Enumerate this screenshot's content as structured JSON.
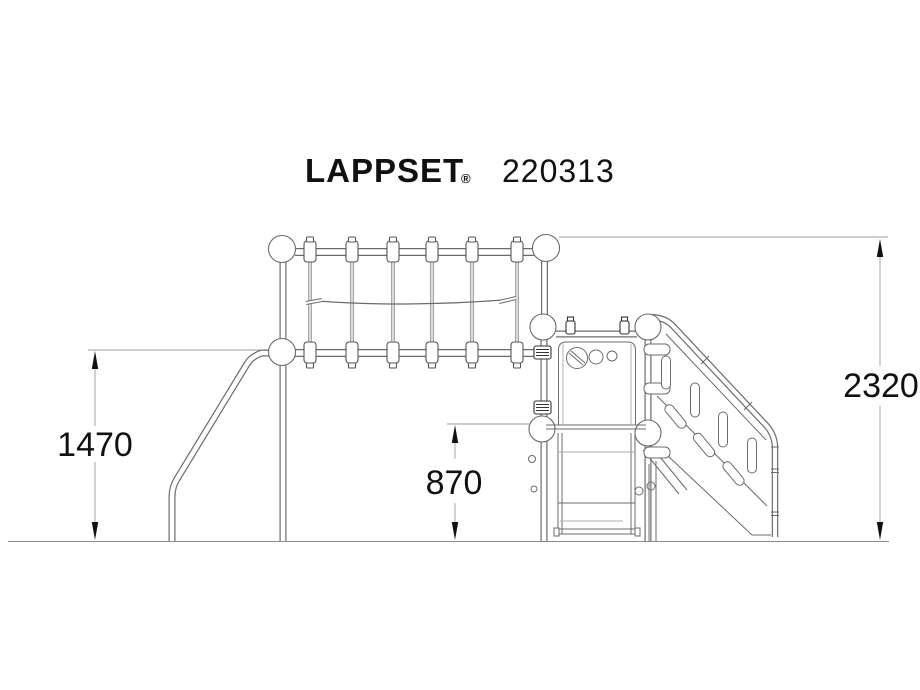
{
  "title": {
    "brand": "LAPPSET",
    "registered_mark": "®",
    "product_code": "220313"
  },
  "dimensions": {
    "net_frame_height": "1470",
    "platform_height": "870",
    "total_height": "2320"
  },
  "colors": {
    "background": "#ffffff",
    "structure_line": "#6b6b6b",
    "dark_fitting_line": "#333333",
    "dimension_line": "#9e9e9e",
    "text": "#111111"
  }
}
